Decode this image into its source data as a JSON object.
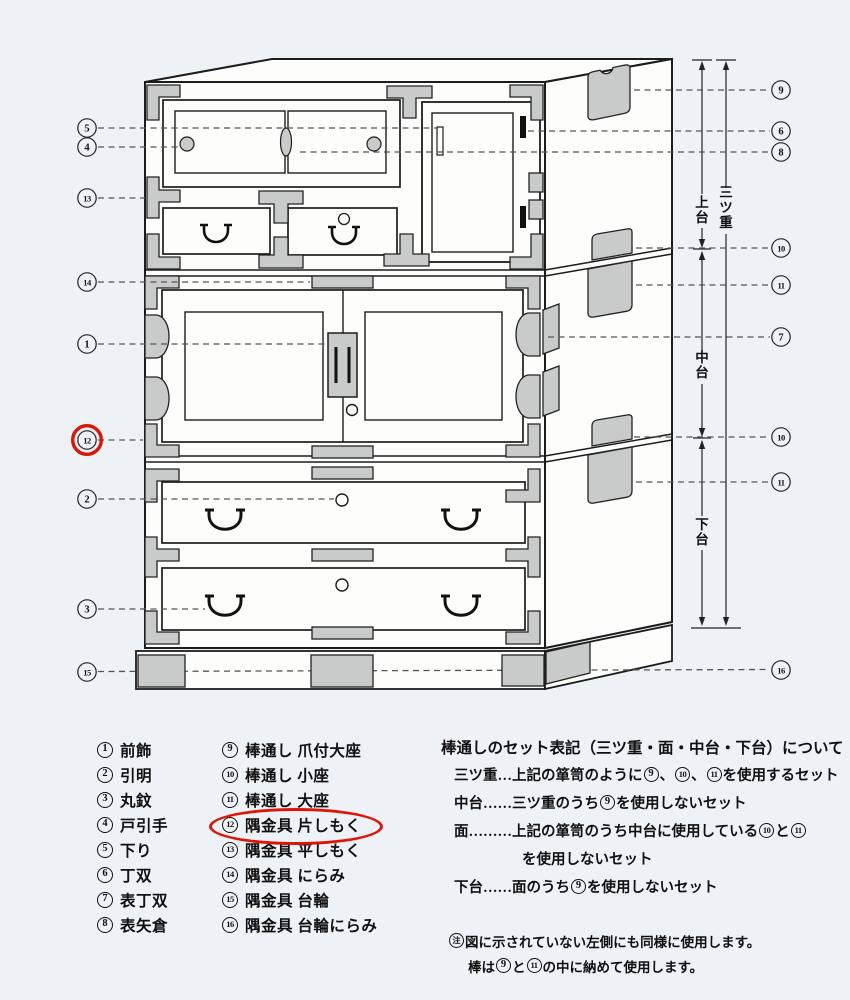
{
  "diagram": {
    "section_labels": {
      "upper_unit": "上台",
      "three_tier": "三ツ重",
      "middle_unit": "中台",
      "lower_unit": "下台"
    },
    "callouts_left": [
      "5",
      "4",
      "13",
      "14",
      "1",
      "12",
      "2",
      "3",
      "15"
    ],
    "callouts_right": [
      "9",
      "6",
      "8",
      "10",
      "11",
      "7",
      "10",
      "11",
      "16"
    ],
    "highlighted_callout": "12"
  },
  "legend": {
    "column1": [
      {
        "num": "1",
        "label": "前飾"
      },
      {
        "num": "2",
        "label": "引明"
      },
      {
        "num": "3",
        "label": "丸鈫"
      },
      {
        "num": "4",
        "label": "戸引手"
      },
      {
        "num": "5",
        "label": "下り"
      },
      {
        "num": "6",
        "label": "丁双"
      },
      {
        "num": "7",
        "label": "表丁双"
      },
      {
        "num": "8",
        "label": "表矢倉"
      }
    ],
    "column2": [
      {
        "num": "9",
        "label": "棒通し 爪付大座"
      },
      {
        "num": "10",
        "label": "棒通し 小座"
      },
      {
        "num": "11",
        "label": "棒通し 大座"
      },
      {
        "num": "12",
        "label": "隅金具 片しもく",
        "highlighted": true
      },
      {
        "num": "13",
        "label": "隅金具 平しもく"
      },
      {
        "num": "14",
        "label": "隅金具 にらみ"
      },
      {
        "num": "15",
        "label": "隅金具 台輪"
      },
      {
        "num": "16",
        "label": "隅金具 台輪にらみ"
      }
    ]
  },
  "notes": {
    "title": "棒通しのセット表記（三ツ重・面・中台・下台）について",
    "lines": [
      {
        "text": "三ツ重…上記の箪笥のように⑨、⑩、⑪を使用するセット",
        "indent": 1
      },
      {
        "text": "中台……三ツ重のうち⑨を使用しないセット",
        "indent": 1
      },
      {
        "text": "面………上記の箪笥のうち中台に使用している⑩と⑪",
        "indent": 1
      },
      {
        "text": "を使用しないセット",
        "indent": 2
      },
      {
        "text": "下台……面のうち⑨を使用しないセット",
        "indent": 1
      }
    ],
    "footnotes": [
      {
        "text": "㊟図に示されていない左側にも同様に使用します。",
        "indent": 0
      },
      {
        "text": "棒は⑨と⑪の中に納めて使用します。",
        "indent": 1
      }
    ]
  },
  "colors": {
    "highlight": "#dd1407",
    "line": "#1c1c1c",
    "bracket_fill": "#c9cbca",
    "face_fill": "#fdfdfc",
    "background": "#edf2f6"
  }
}
